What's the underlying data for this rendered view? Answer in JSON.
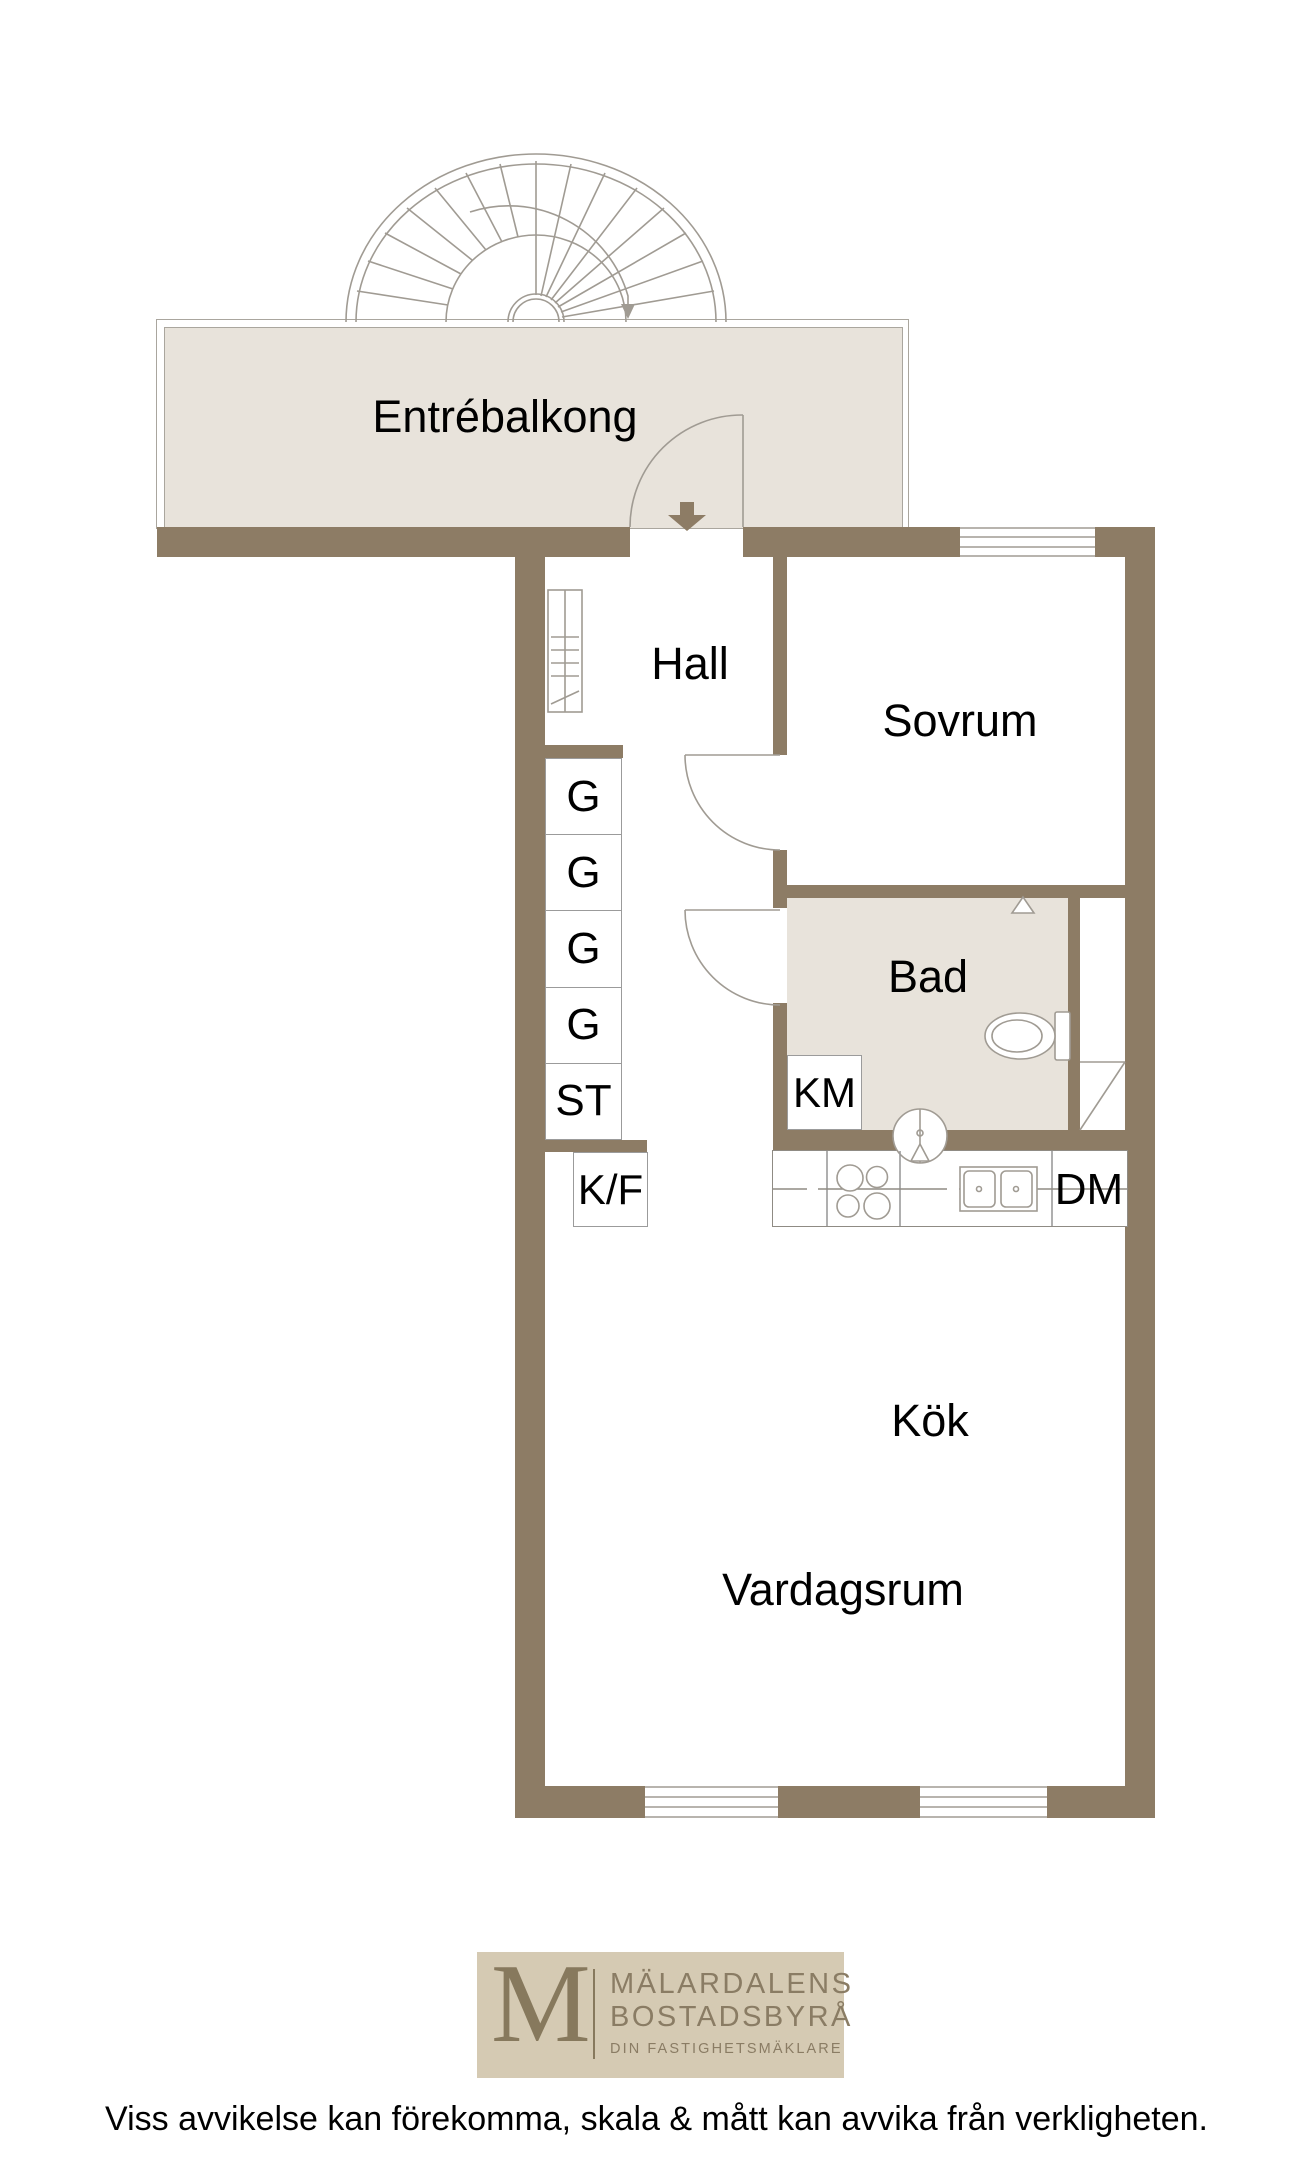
{
  "rooms": {
    "balcony": "Entrébalkong",
    "hall": "Hall",
    "bedroom": "Sovrum",
    "bathroom": "Bad",
    "kitchen": "Kök",
    "living_room": "Vardagsrum"
  },
  "closets": {
    "g1": "G",
    "g2": "G",
    "g3": "G",
    "g4": "G",
    "st": "ST"
  },
  "appliances": {
    "washing_machine": "KM",
    "fridge_freezer": "K/F",
    "dishwasher": "DM"
  },
  "icons": [
    "spiral-staircase-icon",
    "entrance-arrow-icon",
    "door-arc-icon",
    "radiator-icon",
    "toilet-icon",
    "washbasin-icon",
    "shower-corner-icon",
    "stove-icon",
    "kitchen-sink-icon",
    "window-icon",
    "shaft-diagonal-icon"
  ],
  "logo": {
    "monogram": "M",
    "name_line1": "MÄLARDALENS",
    "name_line2": "BOSTADSBYRÅ",
    "tagline": "DIN FASTIGHETSMÄKLARE"
  },
  "disclaimer": "Viss avvikelse kan förekomma, skala & mått kan avvika från verkligheten.",
  "colors": {
    "wall": "#8d7c65",
    "floor": "#e8e3db",
    "line": "#a09b93",
    "logo_bg": "#d5cab3",
    "logo_fg": "#87795d",
    "logo_text": "#8a7c64"
  }
}
